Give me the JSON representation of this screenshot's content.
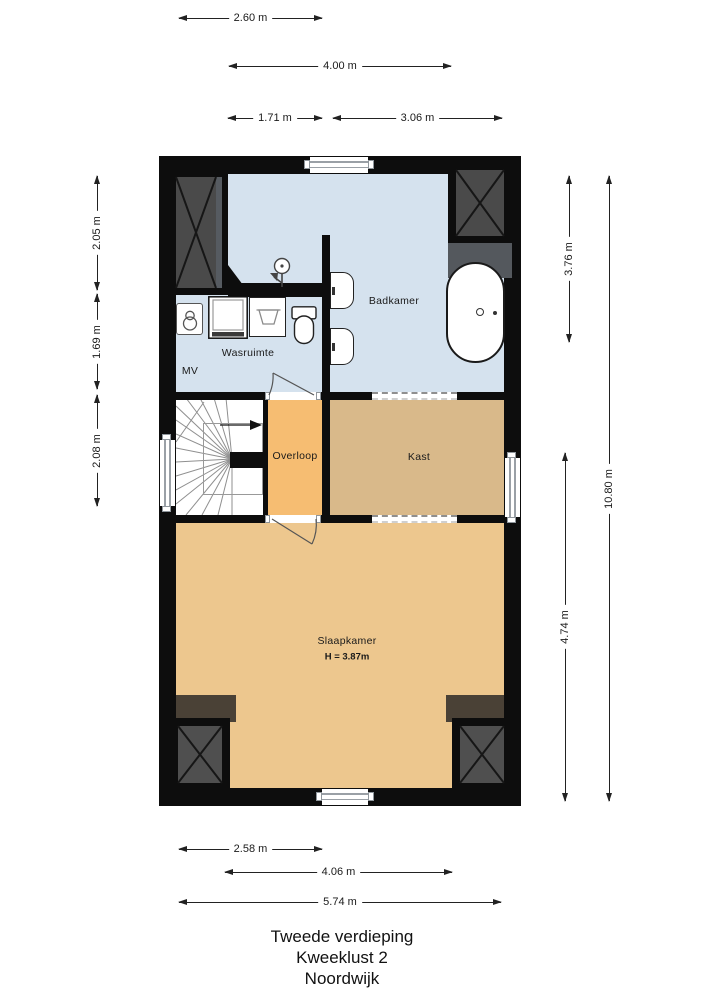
{
  "plan": {
    "title_lines": [
      "Tweede verdieping",
      "Kweeklust 2",
      "Noordwijk"
    ],
    "rooms": {
      "badkamer": "Badkamer",
      "wasruimte": "Wasruimte",
      "mv": "MV",
      "overloop": "Overloop",
      "kast": "Kast",
      "slaapkamer": "Slaapkamer",
      "slaapkamer_height": "H = 3.87m"
    },
    "dimensions": {
      "top": [
        "2.60 m",
        "4.00 m",
        "1.71 m",
        "3.06 m"
      ],
      "bottom": [
        "2.58 m",
        "4.06 m",
        "5.74 m"
      ],
      "left": [
        "2.05 m",
        "1.69 m",
        "2.08 m"
      ],
      "right": [
        "3.76 m",
        "10.80 m",
        "4.74 m"
      ]
    },
    "colors": {
      "wall": "#0d0d0d",
      "bathroom_floor": "#d5e2ee",
      "landing_floor": "#f6bd72",
      "closet_floor": "#d9b98a",
      "bedroom_floor": "#edc78e",
      "wardrobe_panel": "#4a4a4a",
      "attic_closet": "#4a4136"
    }
  }
}
